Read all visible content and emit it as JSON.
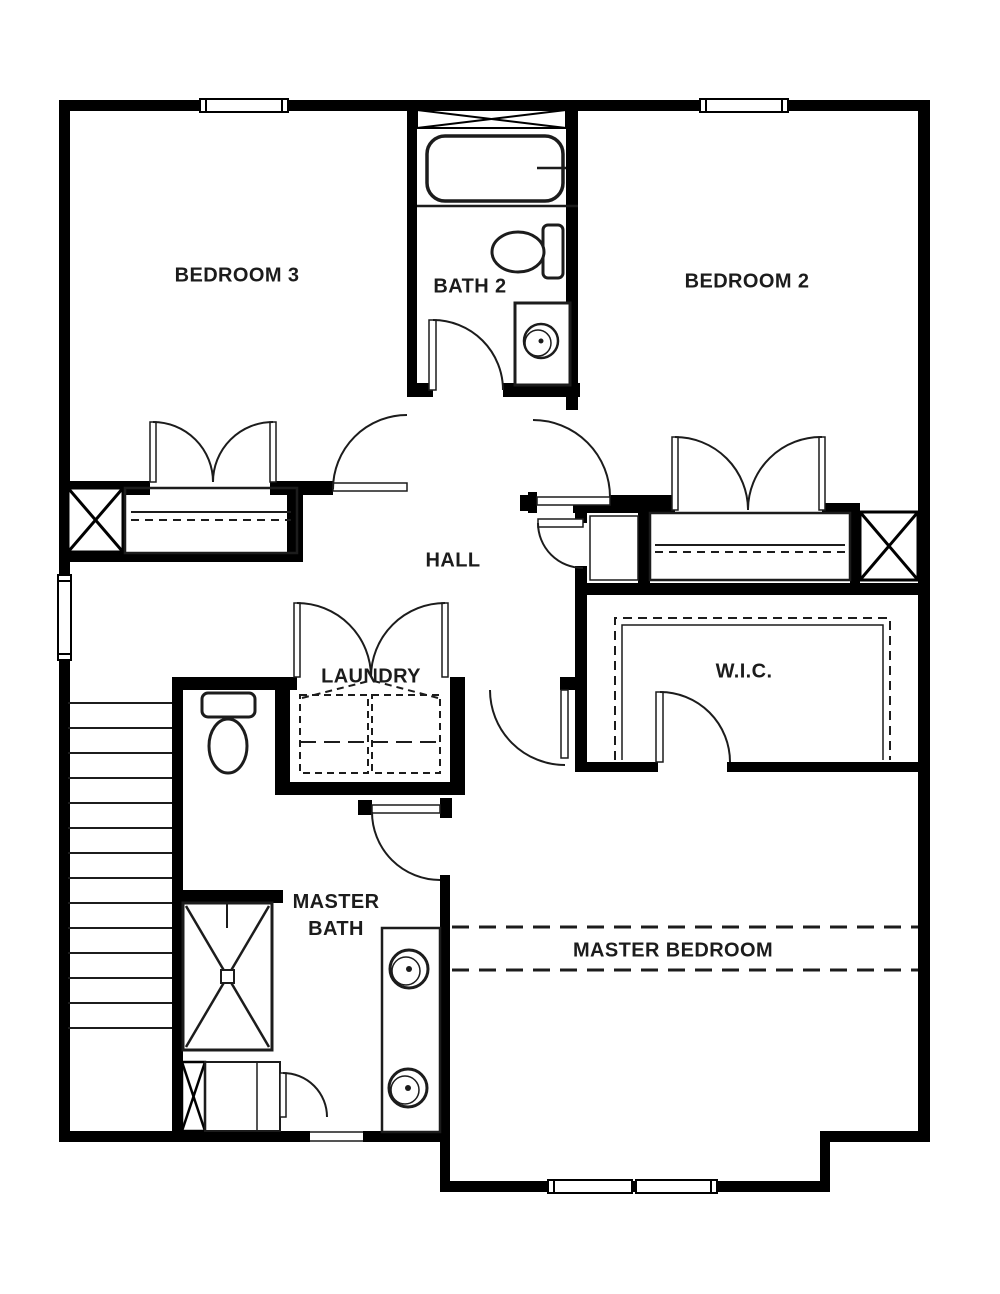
{
  "plan": {
    "colors": {
      "wall": "#000000",
      "line": "#1c1c1c",
      "label": "#1c1c1c",
      "background": "#ffffff"
    },
    "rooms": [
      {
        "name": "bedroom-3",
        "label": "BEDROOM 3"
      },
      {
        "name": "bath-2",
        "label": "BATH 2"
      },
      {
        "name": "bedroom-2",
        "label": "BEDROOM 2"
      },
      {
        "name": "hall",
        "label": "HALL"
      },
      {
        "name": "laundry",
        "label": "LAUNDRY"
      },
      {
        "name": "walk-in-closet",
        "label": "W.I.C."
      },
      {
        "name": "master-bath",
        "label": "MASTER BATH"
      },
      {
        "name": "master-bedroom",
        "label": "MASTER BEDROOM"
      }
    ],
    "fixtures": [
      "bathtub",
      "toilet",
      "vanity-sink",
      "double-vanity-sinks",
      "shower",
      "washer-dryer",
      "stairs",
      "closet-shelf",
      "walk-in-closet-shelving",
      "window",
      "door-swing",
      "bifold-closet-doors",
      "chase-box"
    ]
  }
}
